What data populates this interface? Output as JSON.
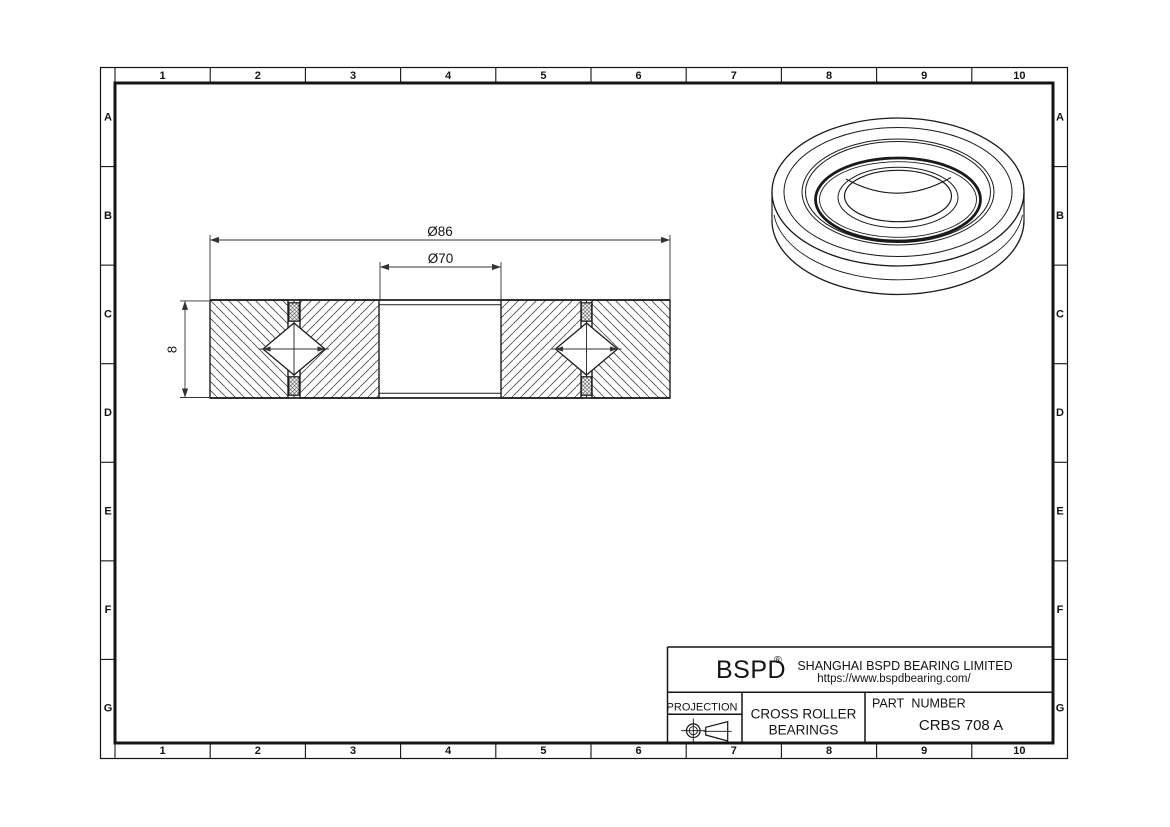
{
  "drawing": {
    "frame": {
      "columns": [
        "1",
        "2",
        "3",
        "4",
        "5",
        "6",
        "7",
        "8",
        "9",
        "10"
      ],
      "rows": [
        "A",
        "B",
        "C",
        "D",
        "E",
        "F",
        "G"
      ]
    },
    "dimensions": {
      "outer_diameter": "Ø86",
      "bore_diameter": "Ø70",
      "width": "8"
    },
    "title_block": {
      "logo": "BSPD",
      "registered_mark": "®",
      "company": "SHANGHAI BSPD BEARING LIMITED",
      "website": "https://www.bspdbearing.com/",
      "projection_label": "PROJECTION",
      "product_line1": "CROSS ROLLER",
      "product_line2": "BEARINGS",
      "part_number_label": "PART NUMBER",
      "part_number": "CRBS 708 A"
    },
    "colors": {
      "line": "#141414",
      "dimension_line": "#333333",
      "hatch": "#4f4f4f",
      "paper": "#ffffff"
    }
  }
}
